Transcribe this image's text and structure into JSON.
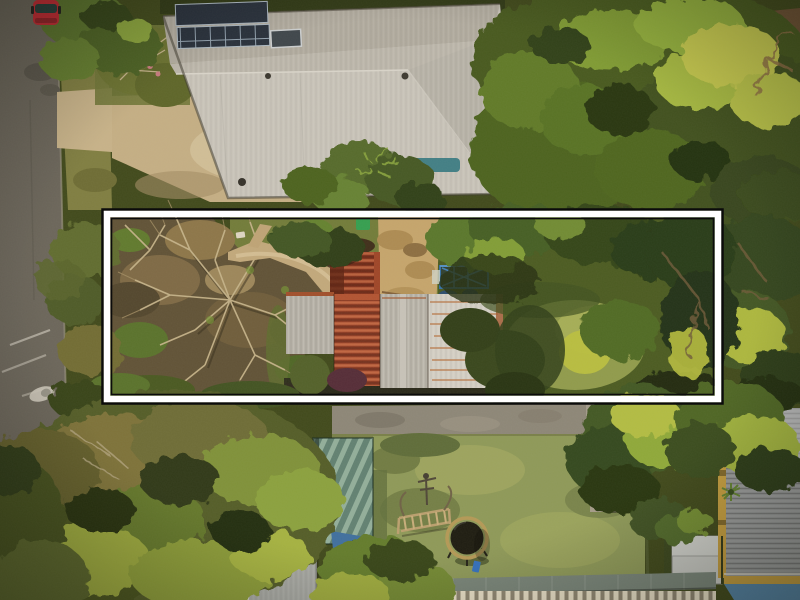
{
  "scene": {
    "type": "aerial-drone-photo",
    "description": "Top-down aerial photograph of a long narrow residential block highlighted with a white rectangular boundary outline, flanked by neighbouring houses to the north and south, with a street running vertically on the left.",
    "canvas": {
      "width": 800,
      "height": 600
    }
  },
  "boundary": {
    "x": 102,
    "y": 209,
    "width": 621,
    "height": 195
  },
  "colors": {
    "road": "#67635a",
    "kerb": "#989284",
    "road_marking": "#d8d4c8",
    "car_red": "#bf2430",
    "grass_verge": "#7c7c40",
    "concrete": "#c6b28a",
    "top_roof_main": "#c7c4bc",
    "top_roof_band": "#afaba1",
    "top_roof_hip": "#b6b3ab",
    "solar_panel": "#222c3a",
    "dark_roof": "#56534b",
    "awning_green": "#31523b",
    "lot_lawn": "#6e7a38",
    "dirt_ground": "#5c4f35",
    "dead_branch": "#c3b28a",
    "driveway_path": "#c0a87c",
    "sand": "#c4a46c",
    "bin_green": "#2f9e4f",
    "carport_rust": "#7c2d1a",
    "roof_rust": "#8a3822",
    "house_gray": "#b5b2aa",
    "house_white": "#d3d0c8",
    "pool_fence_blue": "#2f6ea6",
    "meadow_sunlit": "#8d9a4b",
    "bush_yellow": "#b8bf3e",
    "lane_gray": "#8a8578",
    "bottom_roof": "#b4b7b4",
    "tarp_blue": "#3a6da0",
    "lawn": "#8b9858",
    "trampoline_ring": "#b29856",
    "trampoline_mat": "#17170e",
    "toy_blue": "#2f6fc0",
    "play_frame_wood": "#b99f6f",
    "patio_concrete": "#a29b8a",
    "shed_roof": "#c5c8c5",
    "big_roof": "#8c9092",
    "roof_trim_yellow": "#c29c3e",
    "teal_roof": "#4f82a8",
    "awning_gray_green": "#76847a",
    "boundary_band": "#ffffff",
    "boundary_outline": "#0b0b0b"
  },
  "objects": [
    {
      "name": "street",
      "label": "asphalt street, left side"
    },
    {
      "name": "parked-car",
      "label": "red car parked at top of street"
    },
    {
      "name": "road-markings",
      "label": "faded white painted road markings"
    },
    {
      "name": "driveway-crossing",
      "label": "concrete driveway crossing the verge"
    },
    {
      "name": "north-house",
      "label": "neighbouring house, pale gray hip roof with solar panels"
    },
    {
      "name": "northeast-house",
      "label": "house with dark roof, solar panels and green awning"
    },
    {
      "name": "highlighted-lot",
      "label": "subject property outlined in white"
    },
    {
      "name": "dead-tree",
      "label": "large leafless tree over bare earth inside lot"
    },
    {
      "name": "gravel-path",
      "label": "driveway path curving to the cottage"
    },
    {
      "name": "wheelie-bin",
      "label": "green wheelie bin"
    },
    {
      "name": "sand-patch",
      "label": "sandy cleared area"
    },
    {
      "name": "rusty-carport",
      "label": "rusted red carport roof"
    },
    {
      "name": "cottage",
      "label": "cottage with rusted corrugated iron roof sections"
    },
    {
      "name": "pool-fence",
      "label": "blue framed fence structure"
    },
    {
      "name": "rear-lane",
      "label": "gray rear laneway below the lot"
    },
    {
      "name": "south-house",
      "label": "neighbouring house, gray hip roof"
    },
    {
      "name": "green-patio-roof",
      "label": "teal-green striped patio roof"
    },
    {
      "name": "blue-tarp",
      "label": "blue tarpaulin"
    },
    {
      "name": "backyard-lawn",
      "label": "large green backyard lawn"
    },
    {
      "name": "play-gym",
      "label": "wooden climbing frame"
    },
    {
      "name": "trampoline",
      "label": "round trampoline with tan rim"
    },
    {
      "name": "paved-patio",
      "label": "paved patio with barbecue"
    },
    {
      "name": "garden-shed",
      "label": "small light gray garden shed"
    },
    {
      "name": "southeast-roof",
      "label": "large gray corrugated roof with yellow trim"
    },
    {
      "name": "teal-roof-corner",
      "label": "teal roof in bottom right corner"
    },
    {
      "name": "picket-fence",
      "label": "picket fence with gray-green awning"
    },
    {
      "name": "trees",
      "label": "dense surrounding tree canopy"
    }
  ]
}
